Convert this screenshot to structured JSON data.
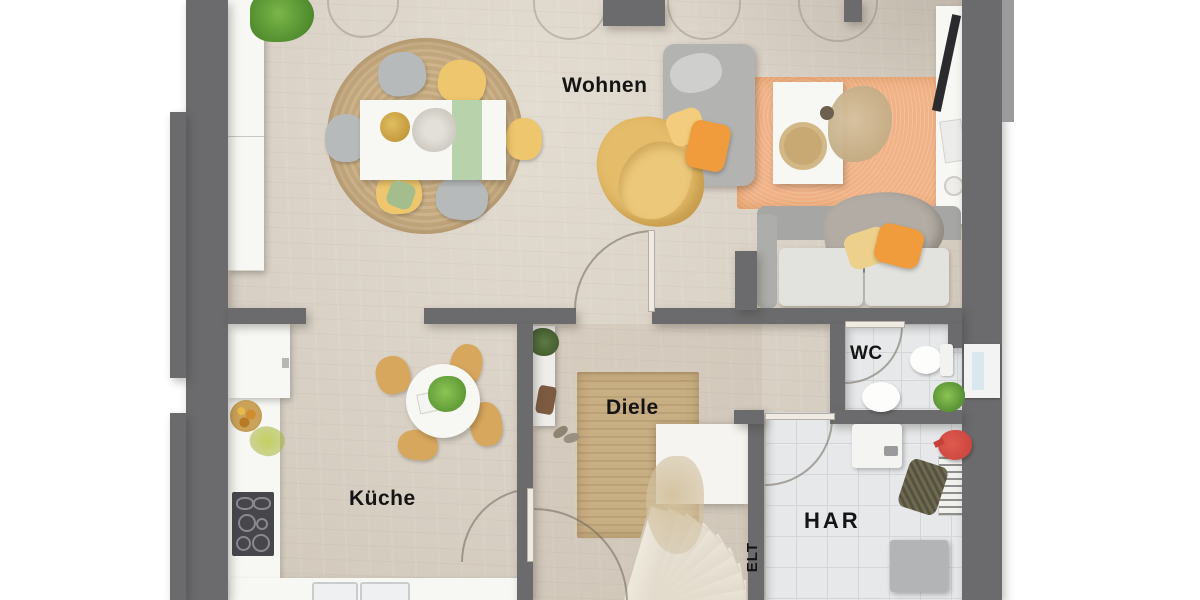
{
  "plan": {
    "type": "floor-plan",
    "language": "de"
  },
  "rooms": [
    {
      "id": "wohnen",
      "label": "Wohnen"
    },
    {
      "id": "kueche",
      "label": "Küche"
    },
    {
      "id": "diele",
      "label": "Diele"
    },
    {
      "id": "wc",
      "label": "WC"
    },
    {
      "id": "har",
      "label": "HAR"
    },
    {
      "id": "elt",
      "label": "ELT"
    }
  ],
  "palette": {
    "wall": "#6b6b6d",
    "wall-light": "#9b9b9d",
    "floor": "#d9d1c5",
    "floor-light": "#e3dcd1",
    "tile": "#e6e8ea",
    "tile-line": "#d4d7da",
    "jute": "#c8ae83",
    "jute-dark": "#bda277",
    "rug-orange": "#f0b286",
    "orange": "#f09c3c",
    "yellow": "#edc66d",
    "sofa-gray": "#b3b3b1",
    "seat": "#e2e2de",
    "white": "#f7f7f4",
    "cooktop": "#47474b",
    "green": "#5f8f3c",
    "wood-chair": "#d7a75d",
    "step": "#efe9dd",
    "step-edge": "#cfc7b7",
    "red": "#c5403a",
    "glass": "#d9e7ee",
    "label": "#141414"
  }
}
